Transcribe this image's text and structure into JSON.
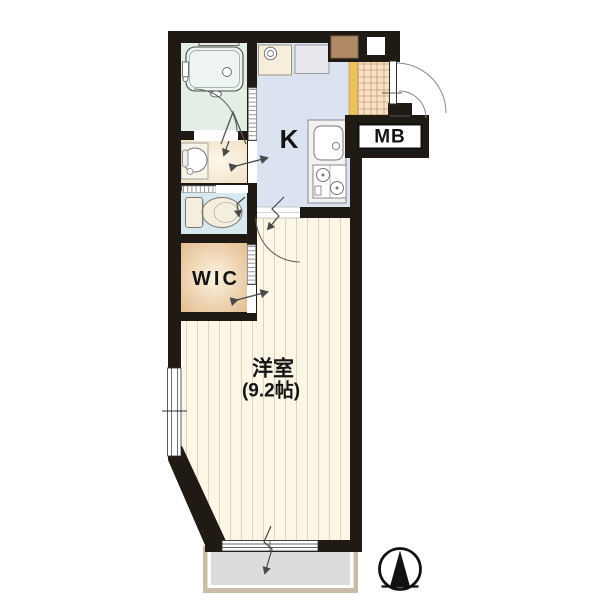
{
  "floor_plan": {
    "rooms": {
      "kitchen": {
        "label": "K"
      },
      "western_room": {
        "label": "洋室",
        "size": "(9.2帖)"
      },
      "walk_in_closet": {
        "label": "WIC"
      },
      "meter_box": {
        "label": "MB"
      }
    },
    "icons": {
      "compass": "north-arrow-compass"
    },
    "colors": {
      "wall": "#201a15",
      "kitchen_floor": "#dbe3f1",
      "bathroom_floor": "#e3eee7",
      "toilet_floor": "#d7e9ef",
      "washroom_floor": "#f4e6cf",
      "wic_floor": "#eecb9e",
      "main_room_floor": "#fcf6e7",
      "genkan_tile": "#f6e2ca",
      "genkan_step": "#ecc25c",
      "balcony_deck": "#dcdcdc",
      "balcony_frame": "#c9bda8",
      "shoe_box": "#b18a67"
    }
  }
}
